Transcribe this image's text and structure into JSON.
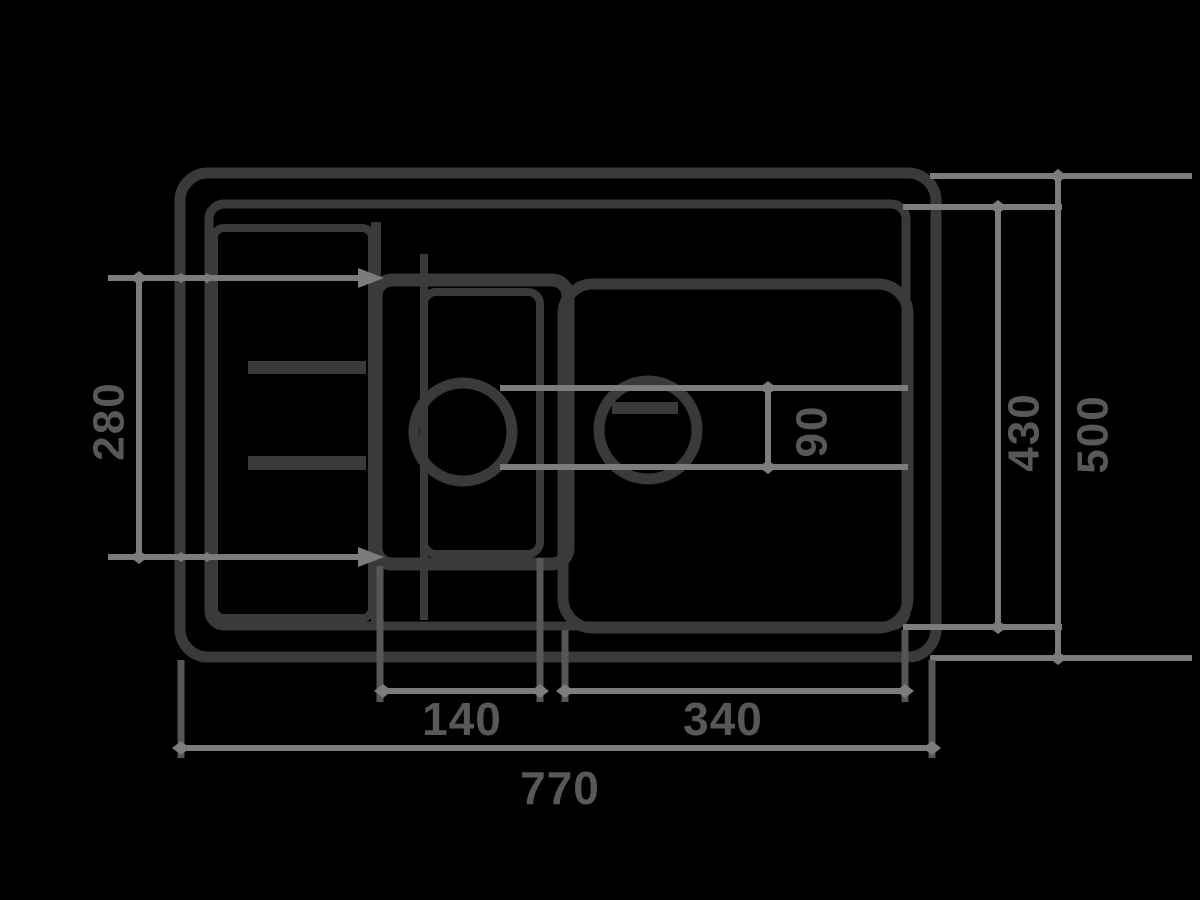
{
  "drawing": {
    "title": "sink-top-view-dimension-drawing",
    "dims": {
      "total_width": "770",
      "half_bowl_width": "140",
      "main_bowl_width": "340",
      "left_height": "280",
      "inner_height": "430",
      "outer_height": "500",
      "drain_diameter": "90"
    },
    "colors": {
      "background": "#000000",
      "structure_lines": "#3a3a3a",
      "dimension_lines": "#7c7c7c",
      "extension_lines": "#565656",
      "label_text": "#585858"
    }
  }
}
